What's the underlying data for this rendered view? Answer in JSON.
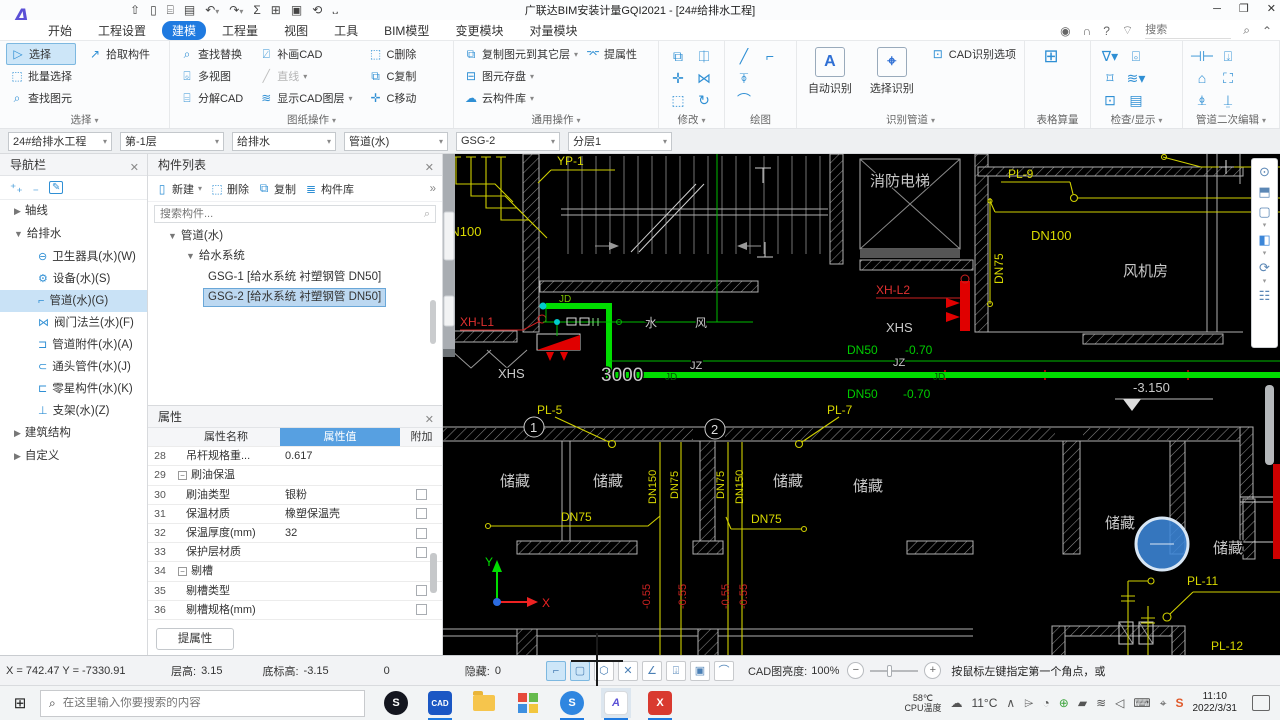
{
  "app": {
    "title": "广联达BIM安装计量GQI2021 - [24#给排水工程]"
  },
  "tabs": {
    "items": [
      "开始",
      "工程设置",
      "建模",
      "工程量",
      "视图",
      "工具",
      "BIM模型",
      "变更模块",
      "对量模块"
    ],
    "search_placeholder": "搜索",
    "help": "?"
  },
  "ribbon": {
    "select": {
      "label": "选择",
      "btn_select": "选择",
      "btn_pick": "拾取构件",
      "btn_batch": "批量选择",
      "btn_find": "查找图元"
    },
    "sheet": {
      "label": "图纸操作",
      "btn_replace": "查找替换",
      "btn_multi": "多视图",
      "btn_explode": "分解CAD",
      "btn_patch": "补画CAD",
      "btn_line": "直线",
      "btn_layers": "显示CAD图层",
      "btn_cdel": "C删除",
      "btn_ccopy": "C复制",
      "btn_cmove": "C移动"
    },
    "common": {
      "label": "通用操作",
      "btn_copyto": "复制图元到其它层",
      "btn_prop": "提属性",
      "btn_save": "图元存盘",
      "btn_cloud": "云构件库"
    },
    "modify": {
      "label": "修改"
    },
    "draw": {
      "label": "绘图"
    },
    "identify": {
      "label": "识别管道",
      "btn_auto": "自动识别",
      "btn_sel": "选择识别",
      "btn_opt": "CAD识别选项"
    },
    "table": {
      "label": "表格算量"
    },
    "check": {
      "label": "检查/显示"
    },
    "pipe_edit": {
      "label": "管道二次编辑"
    }
  },
  "context": {
    "selectors": [
      "24#给排水工程",
      "第-1层",
      "给排水",
      "管道(水)",
      "GSG-2",
      "分层1"
    ]
  },
  "nav": {
    "title": "导航栏",
    "axis": "轴线",
    "group": "给排水",
    "items": [
      "卫生器具(水)(W)",
      "设备(水)(S)",
      "管道(水)(G)",
      "阀门法兰(水)(F)",
      "管道附件(水)(A)",
      "通头管件(水)(J)",
      "零星构件(水)(K)",
      "支架(水)(Z)"
    ],
    "building": "建筑结构",
    "custom": "自定义"
  },
  "components": {
    "title": "构件列表",
    "btn_new": "新建",
    "btn_del": "删除",
    "btn_copy": "复制",
    "btn_lib": "构件库",
    "more": "»",
    "search_placeholder": "搜索构件...",
    "tree_root": "管道(水)",
    "tree_sys": "给水系统",
    "item1": "GSG-1 [给水系统 衬塑钢管 DN50]",
    "item2": "GSG-2 [给水系统 衬塑钢管 DN50]"
  },
  "properties": {
    "title": "属性",
    "col_name": "属性名称",
    "col_value": "属性值",
    "col_extra": "附加",
    "btn_extract": "提属性",
    "rows": [
      {
        "no": "28",
        "name": "吊杆规格重...",
        "value": "0.617"
      },
      {
        "no": "29",
        "name": "刷油保温",
        "value": ""
      },
      {
        "no": "30",
        "name": "刷油类型",
        "value": "银粉"
      },
      {
        "no": "31",
        "name": "保温材质",
        "value": "橡塑保温壳"
      },
      {
        "no": "32",
        "name": "保温厚度(mm)",
        "value": "32"
      },
      {
        "no": "33",
        "name": "保护层材质",
        "value": ""
      },
      {
        "no": "34",
        "name": "剔槽",
        "value": ""
      },
      {
        "no": "35",
        "name": "剔槽类型",
        "value": ""
      },
      {
        "no": "36",
        "name": "剔槽规格(mm)",
        "value": ""
      }
    ]
  },
  "canvas": {
    "labels": {
      "yp1": "YP-1",
      "dn100": "DN100",
      "dn75": "DN75",
      "dn150": "DN150",
      "dn50": "DN50",
      "m070": "-0.70",
      "m055": "-0.55",
      "pl5": "PL-5",
      "pl7": "PL-7",
      "pl9": "PL-9",
      "pl11": "PL-11",
      "pl12": "PL-12",
      "xhl1": "XH-L1",
      "xhl2": "XH-L2",
      "xhs": "XHS",
      "jz": "JZ",
      "jd": "JD",
      "dim3000": "3000",
      "level": "-3.150",
      "elevator": "消防电梯",
      "fanroom": "风机房",
      "storage": "储藏",
      "water": "水",
      "wind": "风",
      "axis1": "1",
      "axis2": "2",
      "ucs_x": "X",
      "ucs_y": "Y"
    }
  },
  "statusbar": {
    "coords": "X = 742.47 Y = -7330.91",
    "floor_height_label": "层高:",
    "floor_height": "3.15",
    "base_elev_label": "底标高:",
    "base_elev": "-3.15",
    "zero": "0",
    "hidden_label": "隐藏:",
    "hidden": "0",
    "brightness_label": "CAD图亮度:",
    "brightness": "100%",
    "hint": "按鼠标左键指定第一个角点，或"
  },
  "taskbar": {
    "search_placeholder": "在这里输入你要搜索的内容",
    "app_s1": "S",
    "app_cad": "CAD",
    "app_s2": "S",
    "app_a": "A",
    "app_x": "X",
    "cpu_temp": "58℃",
    "cpu_label": "CPU温度",
    "weather": "11°C",
    "time": "11:10",
    "date": "2022/3/31"
  }
}
